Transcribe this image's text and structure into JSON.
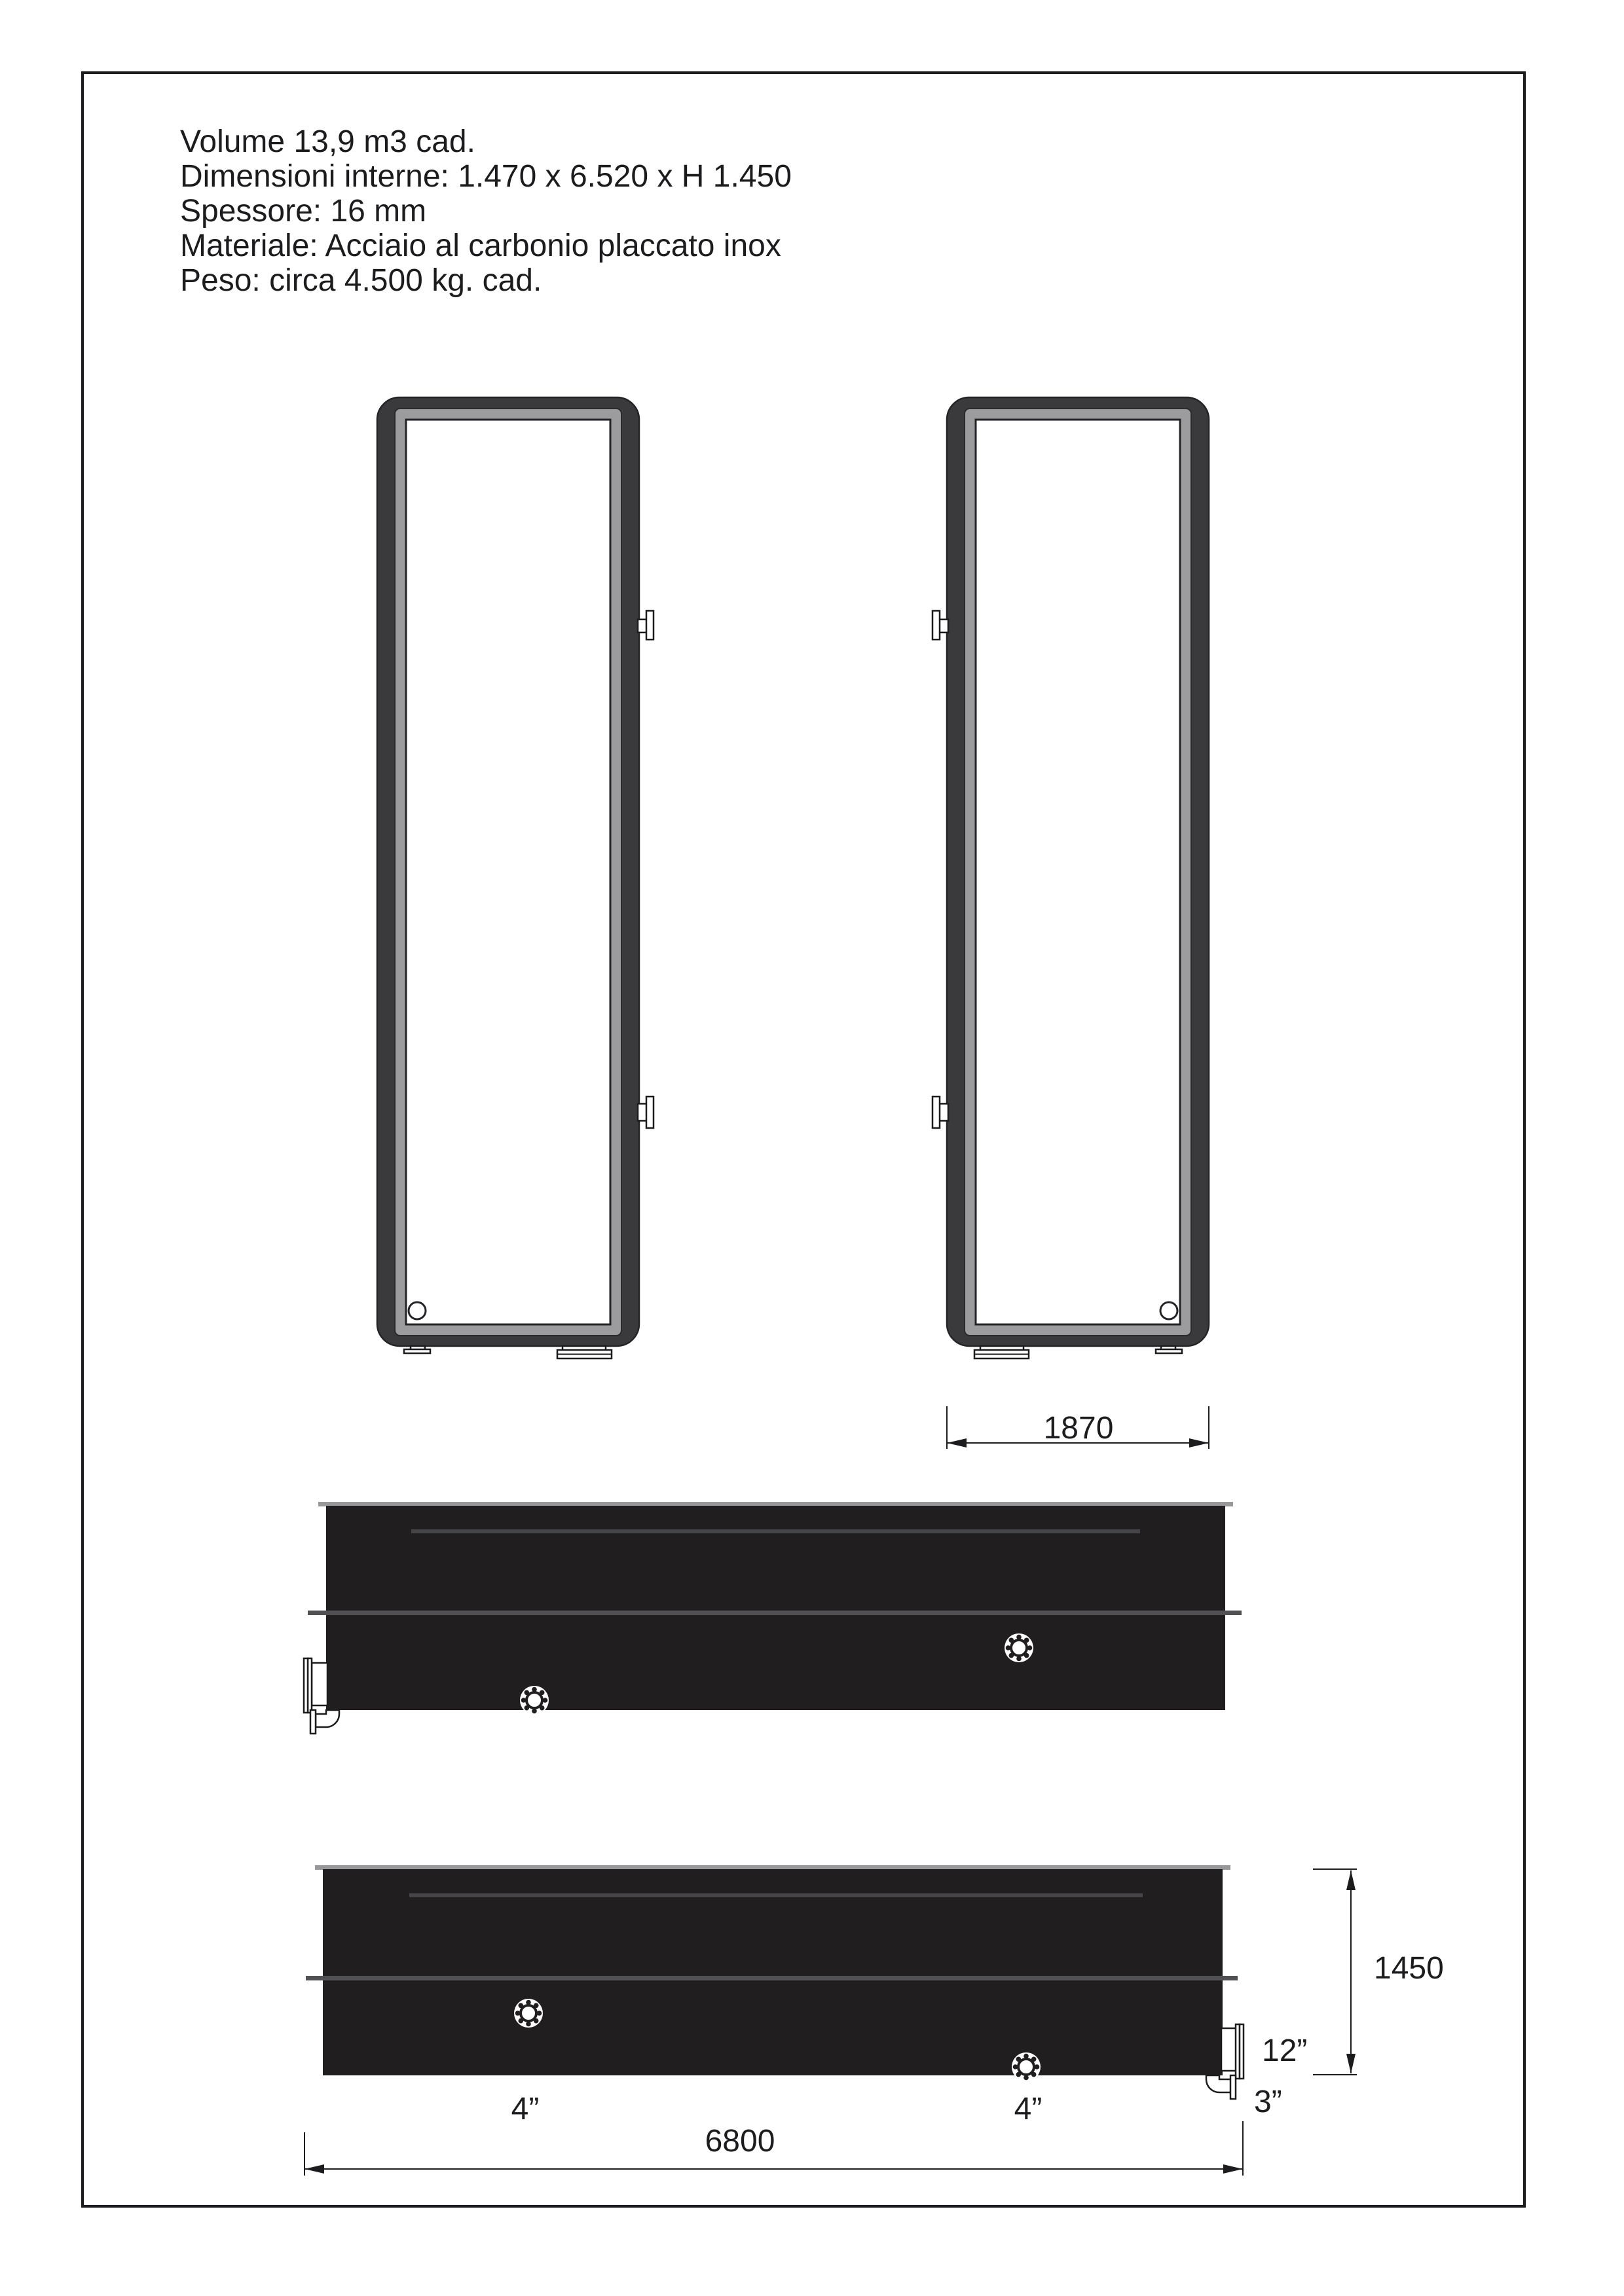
{
  "specs": {
    "lines": [
      "Volume 13,9 m3 cad.",
      "Dimensioni interne: 1.470 x 6.520 x H 1.450",
      "Spessore: 16 mm",
      "Materiale: Acciaio al carbonio placcato inox",
      "Peso: circa 4.500 kg. cad."
    ]
  },
  "dimensions": {
    "tank_width": "1870",
    "tank_height": "1450",
    "tank_length": "6800",
    "manhole_nozzle": "12”",
    "drain_nozzle": "3”",
    "flange_left": "4”",
    "flange_right": "4”"
  },
  "colors": {
    "ink": "#1c1c1e",
    "frame_dark": "#3a3a3c",
    "liner_gray": "#9c9c9e",
    "tank_black": "#201e1f",
    "band_gray": "#515154",
    "lid_gray": "#98989a",
    "inner_line": "#454548"
  }
}
